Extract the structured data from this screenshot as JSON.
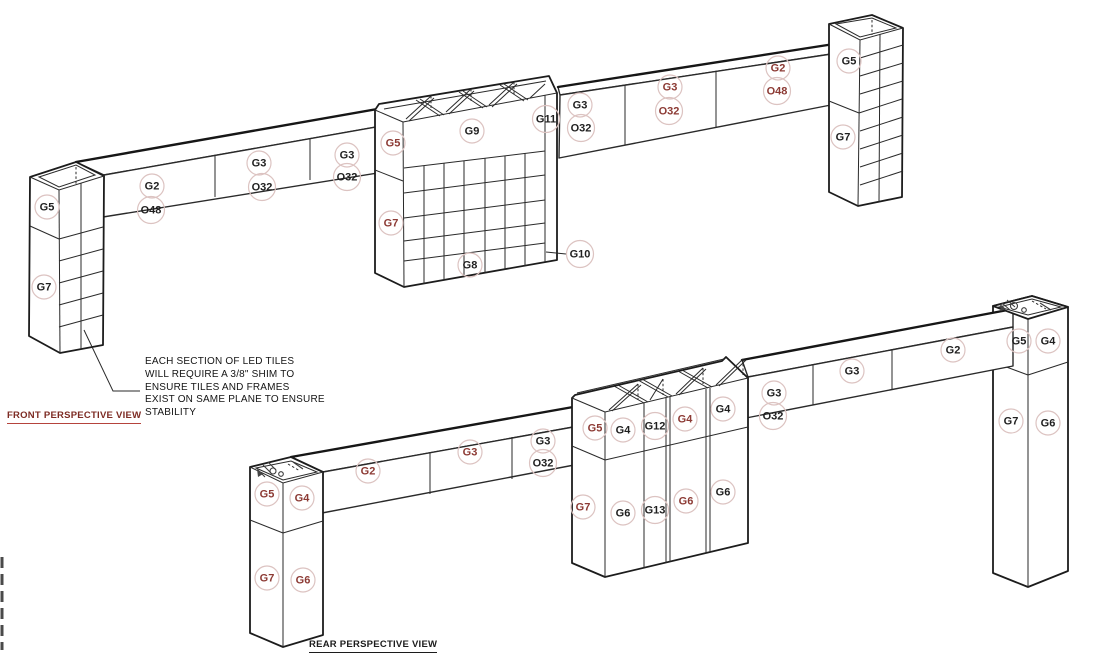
{
  "colors": {
    "line": "#2a2a2a",
    "label_black": "#1f1f1f",
    "label_red": "#8c3a34",
    "circle": "#dcc3c1",
    "front_title": "#7d2b23",
    "front_title_underline": "#b5433c",
    "rear_title": "#1c1c1c"
  },
  "views": {
    "front": {
      "title": "FRONT PERSPECTIVE VIEW",
      "annotation": {
        "lines": [
          "EACH SECTION OF LED TILES",
          "WILL REQUIRE A 3/8\" SHIM TO",
          "ENSURE TILES AND FRAMES",
          "EXIST ON SAME PLANE TO ENSURE",
          "STABILITY"
        ]
      },
      "labels": [
        {
          "text": "G5",
          "x": 47,
          "y": 207,
          "color": "black"
        },
        {
          "text": "G7",
          "x": 44,
          "y": 287,
          "color": "black"
        },
        {
          "text": "G2",
          "x": 152,
          "y": 186,
          "color": "black"
        },
        {
          "text": "O48",
          "x": 151,
          "y": 210,
          "color": "black"
        },
        {
          "text": "G3",
          "x": 259,
          "y": 163,
          "color": "black"
        },
        {
          "text": "O32",
          "x": 262,
          "y": 187,
          "color": "black"
        },
        {
          "text": "G3",
          "x": 347,
          "y": 155,
          "color": "black"
        },
        {
          "text": "O32",
          "x": 347,
          "y": 177,
          "color": "black"
        },
        {
          "text": "G5",
          "x": 393,
          "y": 143,
          "color": "red"
        },
        {
          "text": "G7",
          "x": 391,
          "y": 223,
          "color": "red"
        },
        {
          "text": "G9",
          "x": 472,
          "y": 131,
          "color": "black"
        },
        {
          "text": "G11",
          "x": 546,
          "y": 119,
          "color": "black"
        },
        {
          "text": "G8",
          "x": 470,
          "y": 265,
          "color": "black"
        },
        {
          "text": "G10",
          "x": 580,
          "y": 254,
          "color": "black"
        },
        {
          "text": "G3",
          "x": 580,
          "y": 105,
          "color": "black"
        },
        {
          "text": "O32",
          "x": 581,
          "y": 128,
          "color": "black"
        },
        {
          "text": "G3",
          "x": 670,
          "y": 87,
          "color": "red"
        },
        {
          "text": "O32",
          "x": 669,
          "y": 111,
          "color": "red"
        },
        {
          "text": "G2",
          "x": 778,
          "y": 68,
          "color": "red"
        },
        {
          "text": "O48",
          "x": 777,
          "y": 91,
          "color": "red"
        },
        {
          "text": "G5",
          "x": 849,
          "y": 61,
          "color": "black"
        },
        {
          "text": "G7",
          "x": 843,
          "y": 137,
          "color": "black"
        }
      ]
    },
    "rear": {
      "title": "REAR PERSPECTIVE VIEW",
      "labels": [
        {
          "text": "G5",
          "x": 267,
          "y": 494,
          "color": "red"
        },
        {
          "text": "G4",
          "x": 302,
          "y": 498,
          "color": "red"
        },
        {
          "text": "G7",
          "x": 267,
          "y": 578,
          "color": "red"
        },
        {
          "text": "G6",
          "x": 303,
          "y": 580,
          "color": "red"
        },
        {
          "text": "G2",
          "x": 368,
          "y": 471,
          "color": "red"
        },
        {
          "text": "G3",
          "x": 470,
          "y": 452,
          "color": "red"
        },
        {
          "text": "G3",
          "x": 543,
          "y": 441,
          "color": "black"
        },
        {
          "text": "O32",
          "x": 543,
          "y": 463,
          "color": "black"
        },
        {
          "text": "G5",
          "x": 595,
          "y": 428,
          "color": "red"
        },
        {
          "text": "G4",
          "x": 623,
          "y": 430,
          "color": "black"
        },
        {
          "text": "G12",
          "x": 655,
          "y": 426,
          "color": "black"
        },
        {
          "text": "G4",
          "x": 685,
          "y": 419,
          "color": "red"
        },
        {
          "text": "G4",
          "x": 723,
          "y": 409,
          "color": "black"
        },
        {
          "text": "G7",
          "x": 583,
          "y": 507,
          "color": "red"
        },
        {
          "text": "G6",
          "x": 623,
          "y": 513,
          "color": "black"
        },
        {
          "text": "G13",
          "x": 655,
          "y": 510,
          "color": "black"
        },
        {
          "text": "G6",
          "x": 686,
          "y": 501,
          "color": "red"
        },
        {
          "text": "G6",
          "x": 723,
          "y": 492,
          "color": "black"
        },
        {
          "text": "G3",
          "x": 774,
          "y": 393,
          "color": "black"
        },
        {
          "text": "O32",
          "x": 773,
          "y": 416,
          "color": "black"
        },
        {
          "text": "G3",
          "x": 852,
          "y": 371,
          "color": "black"
        },
        {
          "text": "G2",
          "x": 953,
          "y": 350,
          "color": "black"
        },
        {
          "text": "G5",
          "x": 1019,
          "y": 341,
          "color": "black"
        },
        {
          "text": "G4",
          "x": 1048,
          "y": 341,
          "color": "black"
        },
        {
          "text": "G7",
          "x": 1011,
          "y": 421,
          "color": "black"
        },
        {
          "text": "G6",
          "x": 1048,
          "y": 423,
          "color": "black"
        }
      ]
    }
  }
}
